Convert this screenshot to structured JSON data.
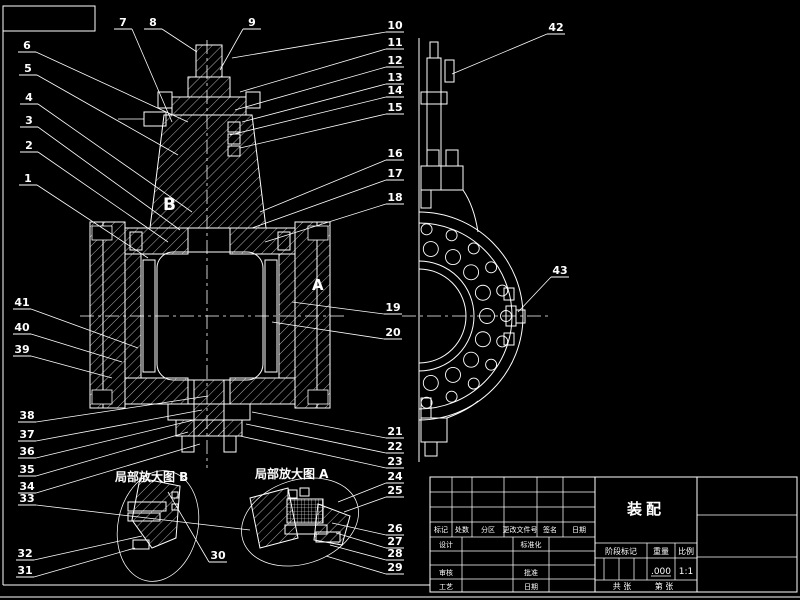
{
  "colors": {
    "background": "#000000",
    "line": "#ffffff"
  },
  "views": {
    "section_marker_b": "B",
    "section_marker_a": "A",
    "detail_b_label": "局部放大图 B",
    "detail_a_label": "局部放大图 A"
  },
  "callouts": [
    {
      "n": "1",
      "x": 28,
      "y": 182,
      "tx": 148,
      "ty": 258
    },
    {
      "n": "2",
      "x": 29,
      "y": 149,
      "tx": 168,
      "ty": 242
    },
    {
      "n": "3",
      "x": 29,
      "y": 124,
      "tx": 180,
      "ty": 230
    },
    {
      "n": "4",
      "x": 29,
      "y": 101,
      "tx": 192,
      "ty": 212
    },
    {
      "n": "5",
      "x": 28,
      "y": 72,
      "tx": 178,
      "ty": 155
    },
    {
      "n": "6",
      "x": 27,
      "y": 49,
      "tx": 188,
      "ty": 122
    },
    {
      "n": "7",
      "x": 123,
      "y": 26,
      "tx": 172,
      "ty": 122
    },
    {
      "n": "8",
      "x": 153,
      "y": 26,
      "tx": 197,
      "ty": 52
    },
    {
      "n": "9",
      "x": 252,
      "y": 26,
      "tx": 220,
      "ty": 70
    },
    {
      "n": "10",
      "x": 395,
      "y": 29,
      "tx": 232,
      "ty": 58
    },
    {
      "n": "11",
      "x": 395,
      "y": 46,
      "tx": 240,
      "ty": 92
    },
    {
      "n": "12",
      "x": 395,
      "y": 64,
      "tx": 235,
      "ty": 110
    },
    {
      "n": "13",
      "x": 395,
      "y": 81,
      "tx": 242,
      "ty": 122
    },
    {
      "n": "14",
      "x": 395,
      "y": 94,
      "tx": 230,
      "ty": 135
    },
    {
      "n": "15",
      "x": 395,
      "y": 111,
      "tx": 240,
      "ty": 148
    },
    {
      "n": "16",
      "x": 395,
      "y": 157,
      "tx": 260,
      "ty": 212
    },
    {
      "n": "17",
      "x": 395,
      "y": 177,
      "tx": 252,
      "ty": 228
    },
    {
      "n": "18",
      "x": 395,
      "y": 201,
      "tx": 265,
      "ty": 242
    },
    {
      "n": "19",
      "x": 393,
      "y": 311,
      "tx": 292,
      "ty": 302
    },
    {
      "n": "20",
      "x": 393,
      "y": 336,
      "tx": 272,
      "ty": 322
    },
    {
      "n": "21",
      "x": 395,
      "y": 435,
      "tx": 252,
      "ty": 412
    },
    {
      "n": "22",
      "x": 395,
      "y": 450,
      "tx": 246,
      "ty": 424
    },
    {
      "n": "23",
      "x": 395,
      "y": 465,
      "tx": 240,
      "ty": 436
    },
    {
      "n": "24",
      "x": 395,
      "y": 480,
      "tx": 338,
      "ty": 502
    },
    {
      "n": "25",
      "x": 395,
      "y": 494,
      "tx": 344,
      "ty": 512
    },
    {
      "n": "26",
      "x": 395,
      "y": 532,
      "tx": 332,
      "ty": 523
    },
    {
      "n": "27",
      "x": 395,
      "y": 545,
      "tx": 336,
      "ty": 533
    },
    {
      "n": "28",
      "x": 395,
      "y": 557,
      "tx": 330,
      "ty": 545
    },
    {
      "n": "29",
      "x": 395,
      "y": 571,
      "tx": 326,
      "ty": 556
    },
    {
      "n": "30",
      "x": 218,
      "y": 559,
      "tx": 168,
      "ty": 492
    },
    {
      "n": "31",
      "x": 25,
      "y": 574,
      "tx": 135,
      "ty": 548
    },
    {
      "n": "32",
      "x": 25,
      "y": 557,
      "tx": 142,
      "ty": 536
    },
    {
      "n": "33",
      "x": 27,
      "y": 502,
      "tx": 250,
      "ty": 530
    },
    {
      "n": "34",
      "x": 27,
      "y": 490,
      "tx": 200,
      "ty": 444
    },
    {
      "n": "35",
      "x": 27,
      "y": 473,
      "tx": 188,
      "ty": 432
    },
    {
      "n": "36",
      "x": 27,
      "y": 455,
      "tx": 194,
      "ty": 420
    },
    {
      "n": "37",
      "x": 27,
      "y": 438,
      "tx": 202,
      "ty": 410
    },
    {
      "n": "38",
      "x": 27,
      "y": 419,
      "tx": 208,
      "ty": 396
    },
    {
      "n": "39",
      "x": 22,
      "y": 353,
      "tx": 112,
      "ty": 378
    },
    {
      "n": "40",
      "x": 22,
      "y": 331,
      "tx": 122,
      "ty": 362
    },
    {
      "n": "41",
      "x": 22,
      "y": 306,
      "tx": 138,
      "ty": 348
    },
    {
      "n": "42",
      "x": 556,
      "y": 31,
      "tx": 452,
      "ty": 74
    },
    {
      "n": "43",
      "x": 560,
      "y": 274,
      "tx": 518,
      "ty": 312
    }
  ],
  "title_block": {
    "title": "装配",
    "header": {
      "mark": "标记",
      "count": "处数",
      "zone": "分区",
      "change_file_no": "更改文件号",
      "signature": "签名",
      "date": "日期"
    },
    "rows": {
      "design": "设计",
      "standardization": "标准化",
      "check": "审核",
      "approve": "批准",
      "process": "工艺",
      "date": "日期"
    },
    "stage_mark": "阶段标记",
    "weight": "重量",
    "scale": "比例",
    "weight_value": ".000",
    "scale_value": "1:1",
    "sheet_total": "共 张",
    "sheet_no": "第 张"
  }
}
